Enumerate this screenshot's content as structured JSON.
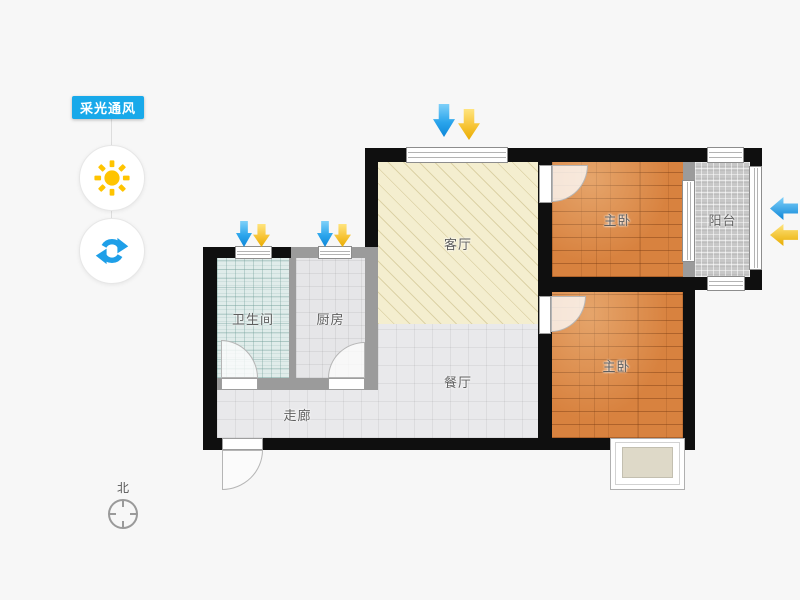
{
  "app": {
    "mode_label": "采光通风"
  },
  "tools": {
    "sun_icon": "sun-icon",
    "refresh_icon": "refresh-icon"
  },
  "rooms": {
    "living": {
      "label": "客厅"
    },
    "dining": {
      "label": "餐厅"
    },
    "corridor": {
      "label": "走廊"
    },
    "bathroom": {
      "label": "卫生间"
    },
    "kitchen": {
      "label": "厨房"
    },
    "bedroom_top": {
      "label": "主卧"
    },
    "bedroom_bottom": {
      "label": "主卧"
    },
    "balcony": {
      "label": "阳台"
    }
  },
  "compass": {
    "label": "北"
  },
  "colors": {
    "accent_blue": "#18a9ea",
    "wind_arrow_blue": "#1e9fe8",
    "light_arrow_yellow": "#f5c518",
    "sun_yellow": "#ffc400",
    "wood_floor": "#d8823f",
    "living_fill": "#f4eecf",
    "bath_fill": "#e0ecea",
    "tile_fill": "#e9e9eb",
    "balcony_fill": "#c7c7c7",
    "wall_dark": "#0f0f0f",
    "wall_gray": "#9b9b9b",
    "background": "#f7f7f7"
  }
}
